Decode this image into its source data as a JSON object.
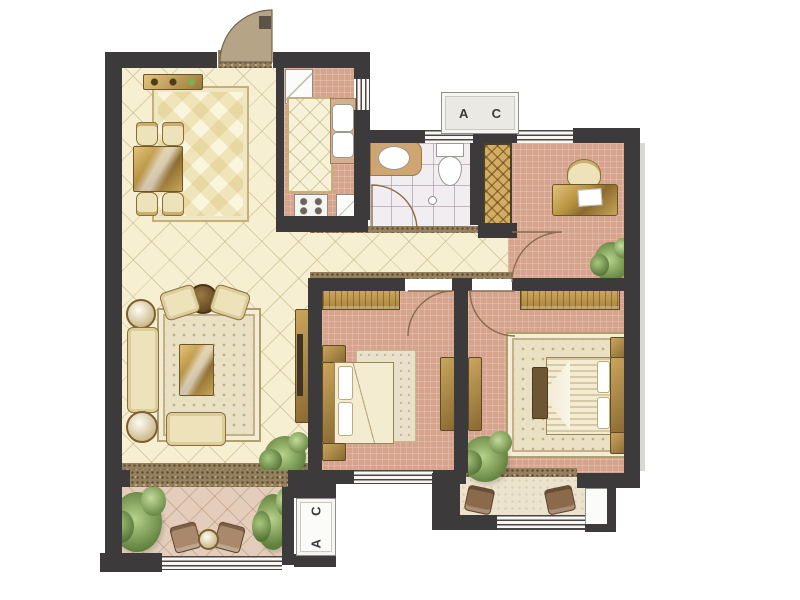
{
  "plan": {
    "type": "apartment-floor-plan",
    "ac_units": {
      "top": {
        "label": "A C"
      },
      "bottom": {
        "label": "A C"
      }
    }
  },
  "colors": {
    "wall": "#3c3a3b",
    "floor_cream": "#f6efd2",
    "floor_salmon": "#d6a38d",
    "floor_bath": "#f2edf0",
    "floor_balcony_left": "#e4cebb",
    "floor_balcony_right": "#ebe3cd",
    "wood": "#b6913f",
    "wardrobe_gold": "#c9a35c",
    "upholstery": "#eee2ba",
    "rug": "#eae1c5",
    "plant_green": "#6b8a46",
    "door_leaf": "#b5a485",
    "ac_label_text": "#3a3a3a"
  },
  "icons": {
    "door-swing-icon": "svg-quarter-arc",
    "window-icon": "striped-band",
    "plant-icon": "css-circle-cluster",
    "bed-icon": "css-rects",
    "sofa-icon": "css-rects",
    "toilet-icon": "css-ellipse",
    "sink-icon": "css-rounded-rect"
  }
}
